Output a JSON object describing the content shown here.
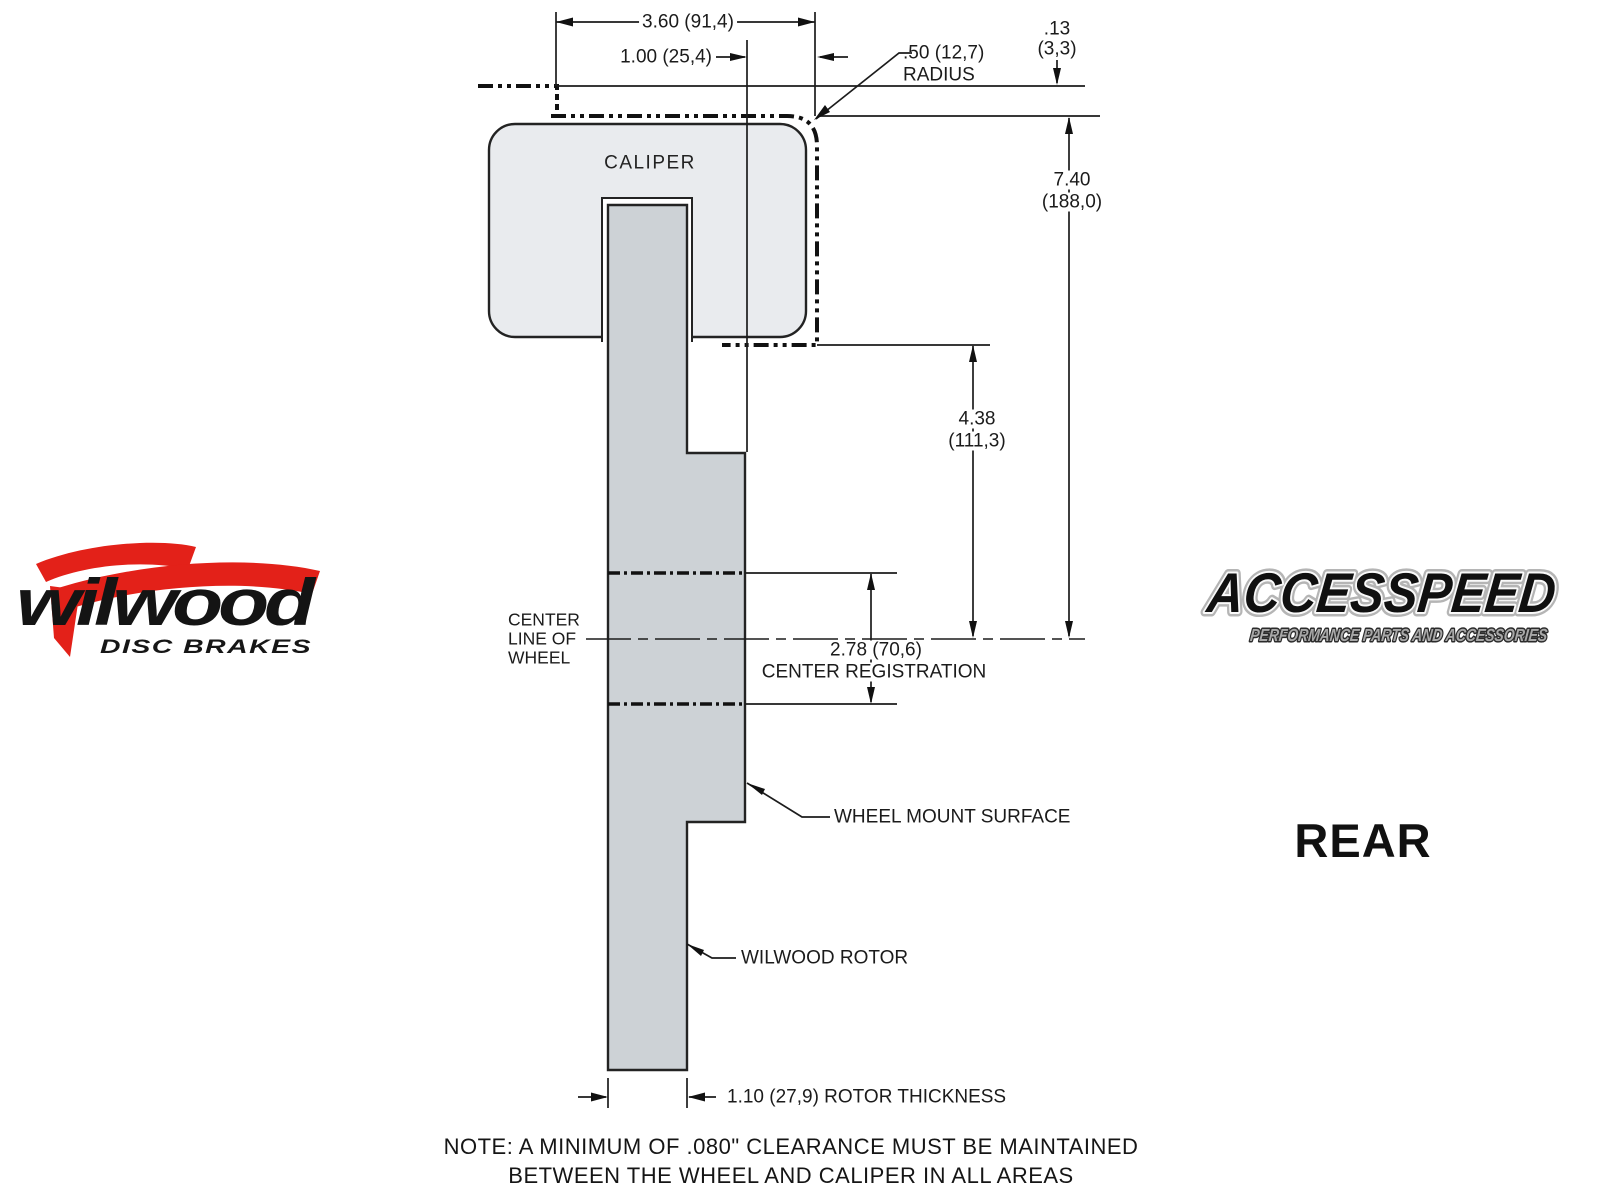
{
  "colors": {
    "logo_red": "#e32119",
    "caliper_fill": "#e9ebee",
    "rotor_fill": "#cdd2d6",
    "line": "#1c1c1c",
    "background": "#ffffff"
  },
  "drawing": {
    "caliper_label": "CALIPER",
    "dims": {
      "overall_width": "3.60 (91,4)",
      "caliper_overhang": "1.00 (25,4)",
      "radius_value": ".50 (12,7)",
      "radius_word": "RADIUS",
      "clearance_in": ".13",
      "clearance_mm": "(3,3)",
      "caliper_height_in": "7.40",
      "caliper_height_mm": "(188,0)",
      "mount_depth_in": "4.38",
      "mount_depth_mm": "(111,3)",
      "center_registration_value": "2.78 (70,6)",
      "center_registration_label": "CENTER REGISTRATION",
      "rotor_thickness": "1.10 (27,9) ROTOR THICKNESS"
    },
    "labels": {
      "center_line_1": "CENTER",
      "center_line_2": "LINE OF",
      "center_line_3": "WHEEL",
      "wheel_mount_surface": "WHEEL MOUNT SURFACE",
      "wilwood_rotor": "WILWOOD ROTOR"
    },
    "note": {
      "line1": "NOTE: A MINIMUM OF .080\" CLEARANCE MUST BE MAINTAINED",
      "line2": "BETWEEN THE WHEEL AND CALIPER IN ALL AREAS"
    }
  },
  "logos": {
    "wilwood": {
      "name": "wilwood",
      "tagline": "DISC BRAKES"
    },
    "accesspeed": {
      "title": "ACCESSPEED",
      "tagline": "PERFORMANCE PARTS AND ACCESSORIES"
    }
  },
  "view_label": "REAR"
}
